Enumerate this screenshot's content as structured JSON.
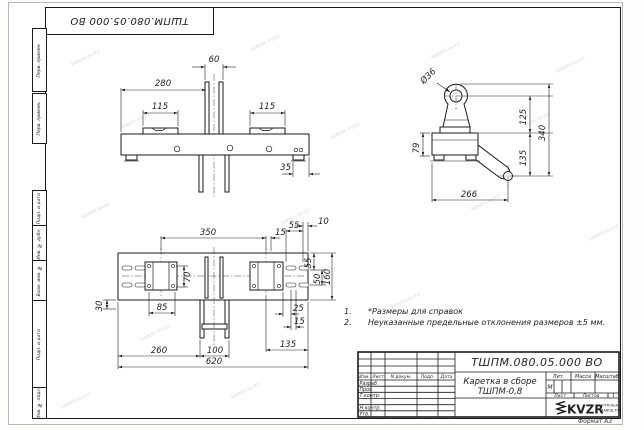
{
  "sheet": {
    "stamp_rotated": "ТШПМ.080.05.000  ВО",
    "format_label": "Формат А3",
    "watermark": "kotelni-kv.kz"
  },
  "margin": {
    "box1": "Перв. примен.",
    "box2": "Перв. примен.",
    "box3": "Подп. и дата",
    "box4": "Инв. № дубл.",
    "box5": "Взам. инв. №",
    "box6": "Подп. и дата",
    "box7": "Инв. № подл."
  },
  "notes": {
    "n1_num": "1.",
    "n1_text": "*Размеры для справок",
    "n2_num": "2.",
    "n2_text": "Неуказанные предельные отклонения размеров  ±5 мм."
  },
  "title_block": {
    "designation": "ТШПМ.080.05.000  ВО",
    "name_line1": "Каретка в сборе",
    "name_line2": "ТШПМ-0,8",
    "col_izm": "Изм.",
    "col_list": "Лист",
    "col_ndoc": "N докум.",
    "col_podp": "Подп.",
    "col_data": "Дата",
    "row_razrab": "Разраб.",
    "row_prov": "Пров.",
    "row_tkontr": "Т.контр.",
    "row_nkontr": "Н.контр.",
    "row_utv": "Утв.",
    "lit_header": "Лит.",
    "mass_header": "Масса",
    "scale_header": "Масштаб",
    "lit_value": "М",
    "sheet_label": "Лист",
    "sheets_label": "Листов",
    "sheets_value": "1",
    "logo_text": "KVZR",
    "company_line1": "КОТЕЛЬНЫЙ",
    "company_line2": "ЗАВОД РЗК"
  },
  "dims": {
    "front": {
      "overall": "280",
      "gap": "60",
      "pad_left": "115",
      "pad_right": "115",
      "edge": "35"
    },
    "side": {
      "hole": "Ø36",
      "upper": "125",
      "total": "340",
      "lower": "135",
      "block": "79",
      "reach": "266"
    },
    "plan": {
      "centers": "350",
      "top15": "15",
      "top55": "55",
      "top10": "10",
      "right55": "55",
      "right50": "50",
      "right160": "160",
      "plate70": "70",
      "plate85": "85",
      "left30": "30",
      "right25": "25",
      "right15": "15",
      "bot260": "260",
      "bot100": "100",
      "bot135": "135",
      "bot620": "620"
    }
  }
}
